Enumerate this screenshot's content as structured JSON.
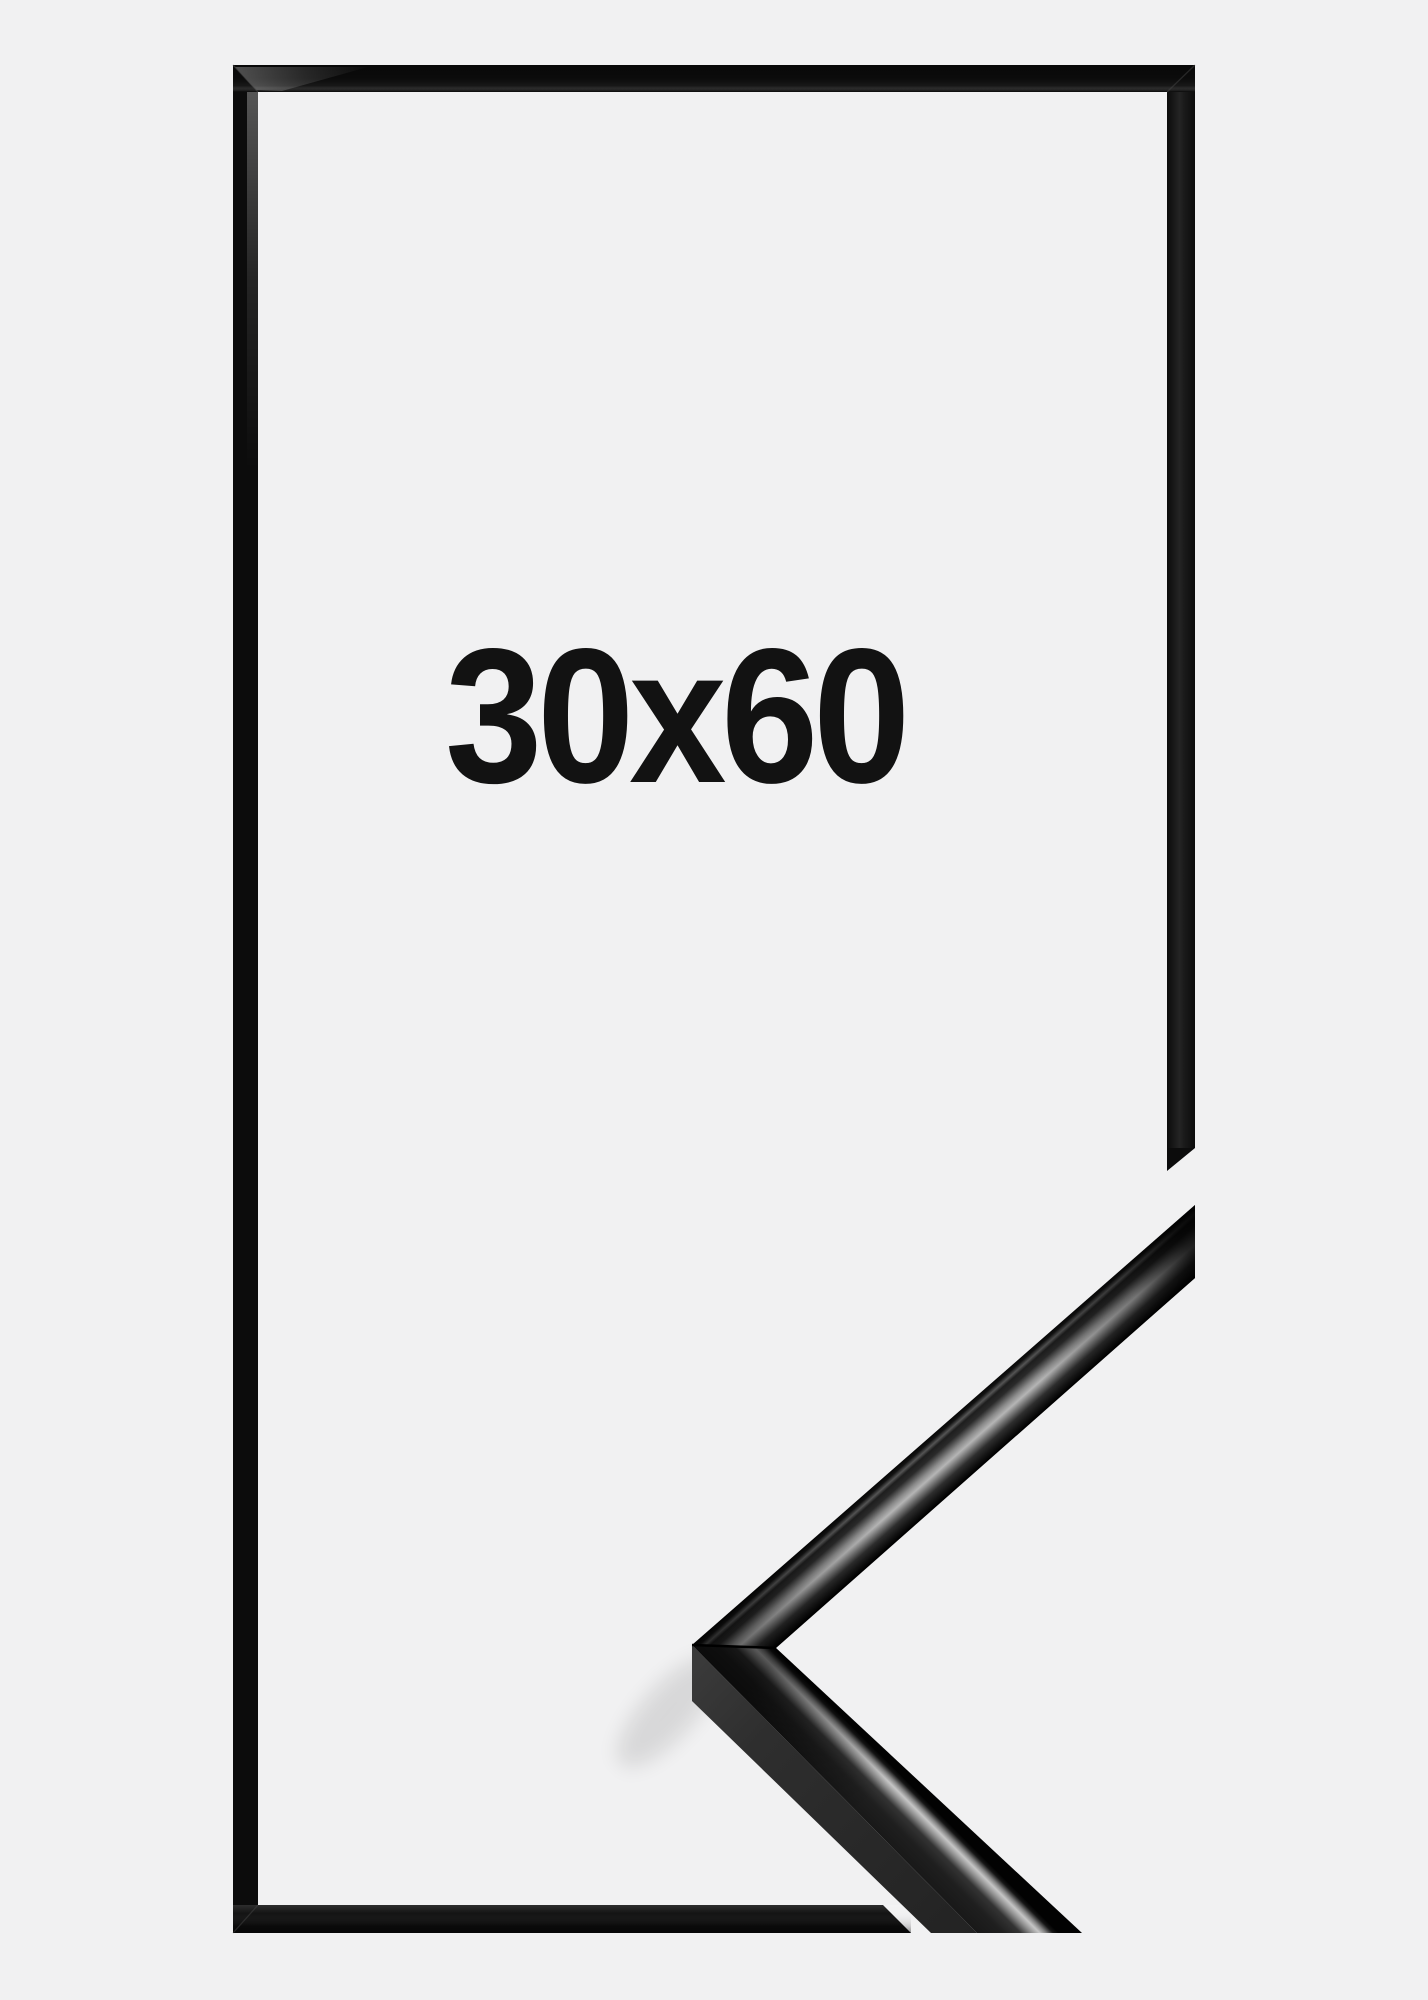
{
  "size_label": "30x60",
  "colors": {
    "background": "#f1f1f2",
    "frame": "#0c0c0c",
    "text": "#121212",
    "gloss_highlight": "#b5b5b5",
    "moulding_side": "#2c2c2c"
  }
}
